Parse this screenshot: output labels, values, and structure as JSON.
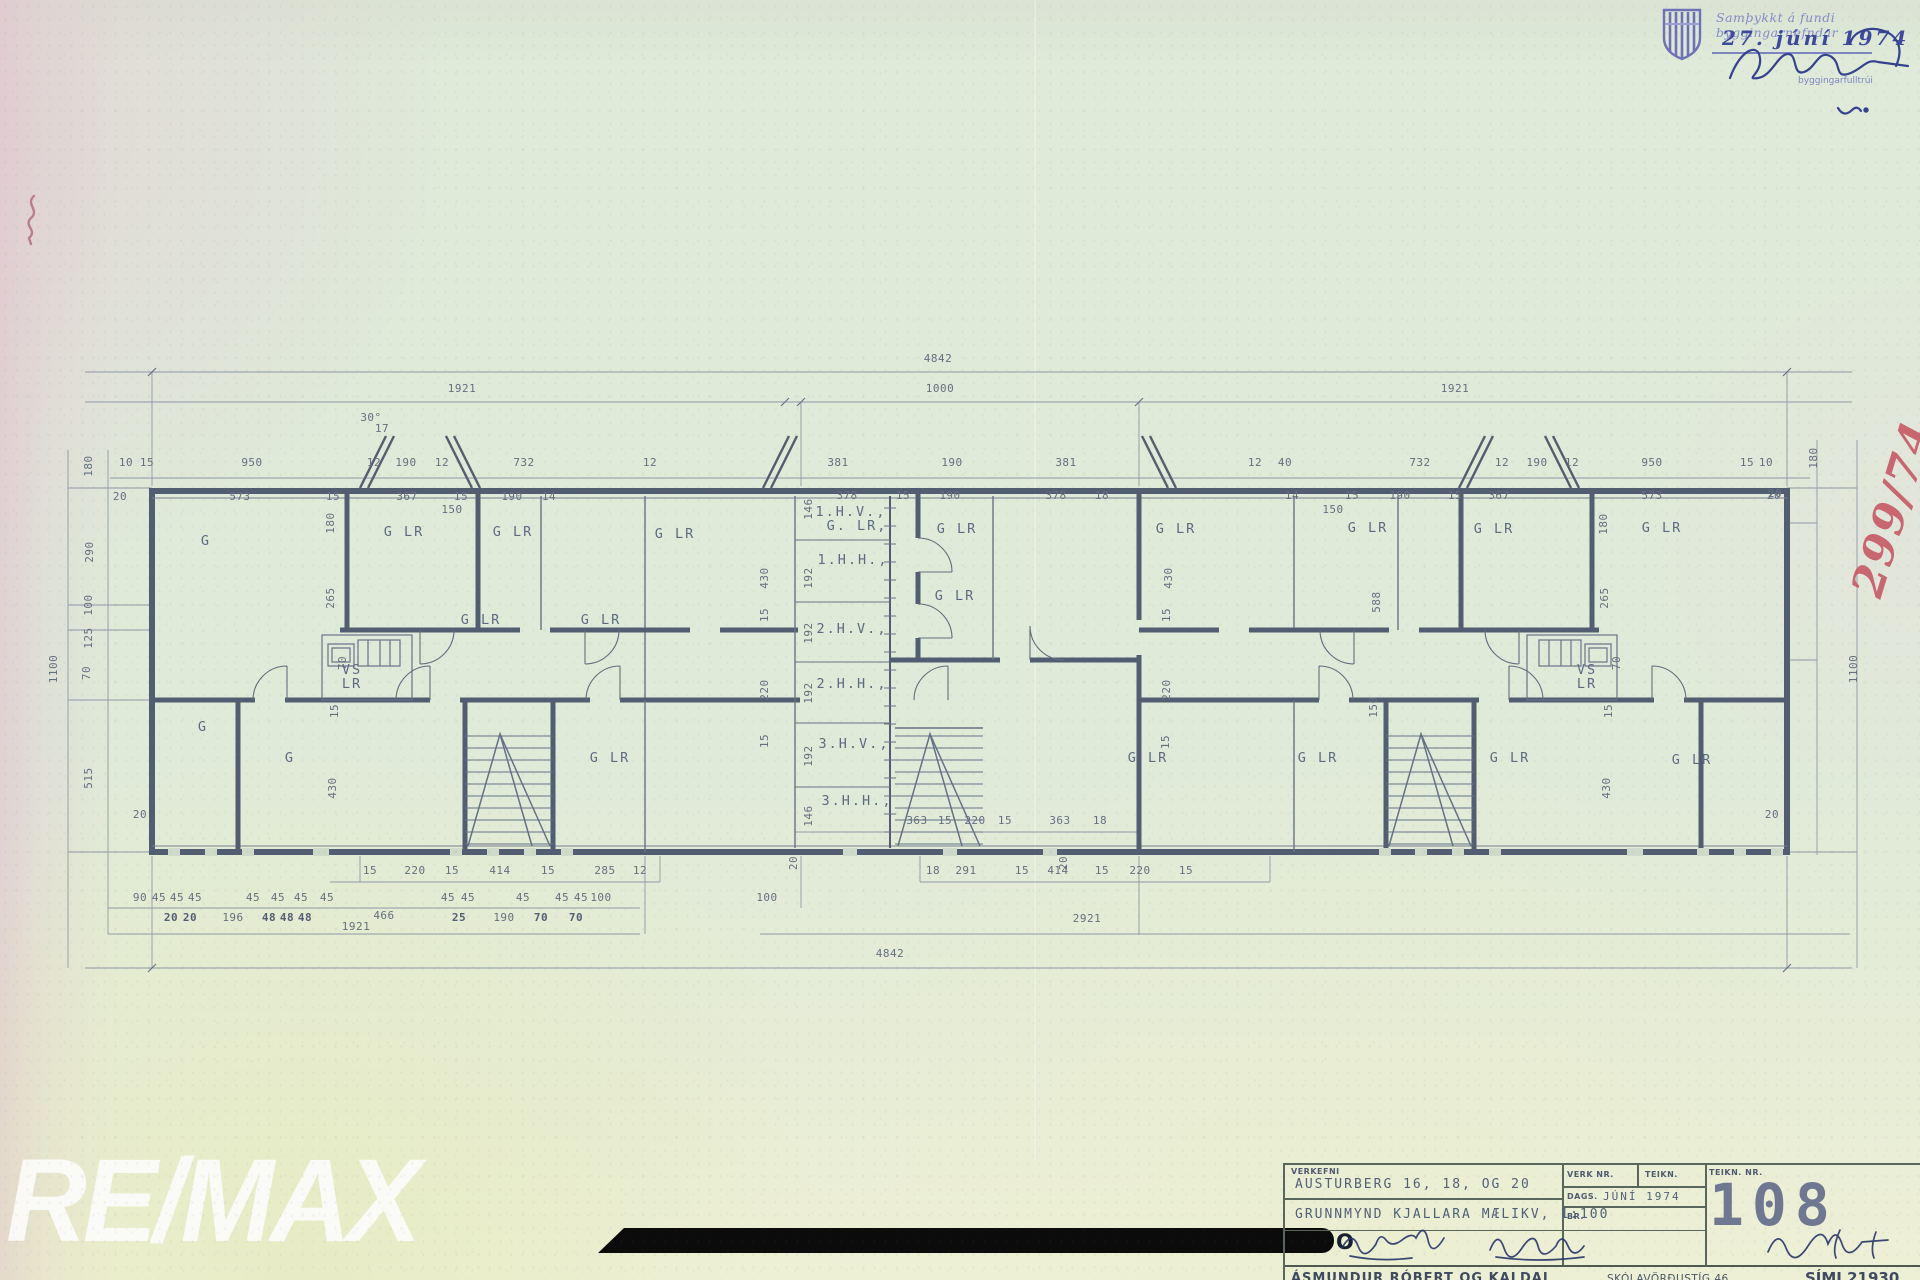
{
  "stamp": {
    "line1": "Samþykkt á fundi byggingarnefndar",
    "date": "27. júní 1974",
    "official": "byggingarfulltrúi"
  },
  "red_note": {
    "text": "299/74"
  },
  "watermark": {
    "text": "RE/MAX",
    "redacted_letter": "O"
  },
  "title_block": {
    "verkefni_label": "VERKEFNI",
    "project": "AUSTURBERG  16, 18, OG 20",
    "drawing_title": "GRUNNMYND KJALLARA  MÆLIKV, 1:100",
    "verk_nr_label": "VERK NR.",
    "teikn_label": "TEIKN.",
    "dags_label": "DAGS.",
    "dags_value": "JÚNÍ 1974",
    "br_label": "BR.",
    "teikn_nr_label": "TEIKN. NR.",
    "drawing_number": "108",
    "firm": "ÁSMUNDUR RÓBERT OG KALDAL",
    "address": "SKÓLAVÖRÐUSTÍG 46",
    "phone": "SÍMI 21930"
  },
  "plan": {
    "ink_color": "#49536a",
    "dim_color": "#5c6679",
    "dims": [
      {
        "t": "4842",
        "x": 938,
        "y": 362
      },
      {
        "t": "1921",
        "x": 462,
        "y": 392
      },
      {
        "t": "1000",
        "x": 940,
        "y": 392
      },
      {
        "t": "1921",
        "x": 1455,
        "y": 392
      },
      {
        "t": "10",
        "x": 126,
        "y": 466
      },
      {
        "t": "15",
        "x": 147,
        "y": 466
      },
      {
        "t": "950",
        "x": 252,
        "y": 466
      },
      {
        "t": "12",
        "x": 374,
        "y": 466
      },
      {
        "t": "190",
        "x": 406,
        "y": 466
      },
      {
        "t": "12",
        "x": 442,
        "y": 466
      },
      {
        "t": "732",
        "x": 524,
        "y": 466
      },
      {
        "t": "12",
        "x": 650,
        "y": 466
      },
      {
        "t": "381",
        "x": 838,
        "y": 466
      },
      {
        "t": "190",
        "x": 952,
        "y": 466
      },
      {
        "t": "381",
        "x": 1066,
        "y": 466
      },
      {
        "t": "12",
        "x": 1255,
        "y": 466
      },
      {
        "t": "40",
        "x": 1285,
        "y": 466
      },
      {
        "t": "732",
        "x": 1420,
        "y": 466
      },
      {
        "t": "12",
        "x": 1502,
        "y": 466
      },
      {
        "t": "190",
        "x": 1537,
        "y": 466
      },
      {
        "t": "12",
        "x": 1572,
        "y": 466
      },
      {
        "t": "950",
        "x": 1652,
        "y": 466
      },
      {
        "t": "15",
        "x": 1747,
        "y": 466
      },
      {
        "t": "10",
        "x": 1766,
        "y": 466
      },
      {
        "t": "20",
        "x": 120,
        "y": 500
      },
      {
        "t": "573",
        "x": 240,
        "y": 500
      },
      {
        "t": "15",
        "x": 333,
        "y": 500
      },
      {
        "t": "367",
        "x": 407,
        "y": 500
      },
      {
        "t": "15",
        "x": 461,
        "y": 500
      },
      {
        "t": "190",
        "x": 512,
        "y": 500
      },
      {
        "t": "14",
        "x": 549,
        "y": 500
      },
      {
        "t": "150",
        "x": 452,
        "y": 513
      },
      {
        "t": "378",
        "x": 847,
        "y": 499
      },
      {
        "t": "15",
        "x": 903,
        "y": 499
      },
      {
        "t": "190",
        "x": 950,
        "y": 499
      },
      {
        "t": "378",
        "x": 1056,
        "y": 499
      },
      {
        "t": "18",
        "x": 1102,
        "y": 499
      },
      {
        "t": "14",
        "x": 1292,
        "y": 499
      },
      {
        "t": "15",
        "x": 1352,
        "y": 499
      },
      {
        "t": "190",
        "x": 1400,
        "y": 499
      },
      {
        "t": "15",
        "x": 1455,
        "y": 499
      },
      {
        "t": "367",
        "x": 1499,
        "y": 499
      },
      {
        "t": "573",
        "x": 1652,
        "y": 499
      },
      {
        "t": "20",
        "x": 1774,
        "y": 499
      },
      {
        "t": "150",
        "x": 1333,
        "y": 513
      },
      {
        "t": "30°",
        "x": 371,
        "y": 421,
        "s": 9
      },
      {
        "t": "17",
        "x": 382,
        "y": 432,
        "s": 9
      },
      {
        "t": "180",
        "x": 92,
        "y": 466,
        "r": -90
      },
      {
        "t": "290",
        "x": 93,
        "y": 552,
        "r": -90
      },
      {
        "t": "100",
        "x": 92,
        "y": 605,
        "r": -90
      },
      {
        "t": "125",
        "x": 92,
        "y": 638,
        "r": -90
      },
      {
        "t": "70",
        "x": 90,
        "y": 673,
        "r": -90
      },
      {
        "t": "515",
        "x": 92,
        "y": 778,
        "r": -90
      },
      {
        "t": "1100",
        "x": 57,
        "y": 669,
        "r": -90
      },
      {
        "t": "20",
        "x": 140,
        "y": 818
      },
      {
        "t": "180",
        "x": 334,
        "y": 523,
        "r": -90
      },
      {
        "t": "265",
        "x": 334,
        "y": 598,
        "r": -90
      },
      {
        "t": "70",
        "x": 346,
        "y": 663,
        "r": -90
      },
      {
        "t": "15",
        "x": 338,
        "y": 711,
        "r": -90
      },
      {
        "t": "430",
        "x": 336,
        "y": 788,
        "r": -90
      },
      {
        "t": "430",
        "x": 768,
        "y": 578,
        "r": -90
      },
      {
        "t": "15",
        "x": 768,
        "y": 615,
        "r": -90
      },
      {
        "t": "220",
        "x": 768,
        "y": 690,
        "r": -90
      },
      {
        "t": "15",
        "x": 768,
        "y": 741,
        "r": -90
      },
      {
        "t": "146",
        "x": 812,
        "y": 509,
        "r": -90
      },
      {
        "t": "192",
        "x": 812,
        "y": 578,
        "r": -90
      },
      {
        "t": "192",
        "x": 812,
        "y": 633,
        "r": -90
      },
      {
        "t": "192",
        "x": 812,
        "y": 693,
        "r": -90
      },
      {
        "t": "192",
        "x": 812,
        "y": 756,
        "r": -90
      },
      {
        "t": "146",
        "x": 812,
        "y": 816,
        "r": -90
      },
      {
        "t": "430",
        "x": 1172,
        "y": 578,
        "r": -90
      },
      {
        "t": "15",
        "x": 1170,
        "y": 615,
        "r": -90
      },
      {
        "t": "220",
        "x": 1170,
        "y": 690,
        "r": -90
      },
      {
        "t": "15",
        "x": 1169,
        "y": 742,
        "r": -90
      },
      {
        "t": "588",
        "x": 1380,
        "y": 602,
        "r": -90
      },
      {
        "t": "150",
        "x": 1377,
        "y": 707,
        "r": -90
      },
      {
        "t": "180",
        "x": 1607,
        "y": 524,
        "r": -90
      },
      {
        "t": "265",
        "x": 1608,
        "y": 598,
        "r": -90
      },
      {
        "t": "70",
        "x": 1620,
        "y": 663,
        "r": -90
      },
      {
        "t": "15",
        "x": 1612,
        "y": 711,
        "r": -90
      },
      {
        "t": "430",
        "x": 1610,
        "y": 788,
        "r": -90
      },
      {
        "t": "180",
        "x": 1817,
        "y": 458,
        "r": -90
      },
      {
        "t": "20",
        "x": 1775,
        "y": 497
      },
      {
        "t": "1100",
        "x": 1857,
        "y": 669,
        "r": -90
      },
      {
        "t": "20",
        "x": 1772,
        "y": 818
      },
      {
        "t": "363",
        "x": 917,
        "y": 824
      },
      {
        "t": "15",
        "x": 945,
        "y": 824
      },
      {
        "t": "220",
        "x": 975,
        "y": 824
      },
      {
        "t": "15",
        "x": 1005,
        "y": 824
      },
      {
        "t": "363",
        "x": 1060,
        "y": 824
      },
      {
        "t": "18",
        "x": 1100,
        "y": 824
      },
      {
        "t": "20",
        "x": 797,
        "y": 863,
        "r": -90
      },
      {
        "t": "20",
        "x": 1067,
        "y": 863,
        "r": -90
      },
      {
        "t": "15",
        "x": 370,
        "y": 874
      },
      {
        "t": "220",
        "x": 415,
        "y": 874
      },
      {
        "t": "15",
        "x": 452,
        "y": 874
      },
      {
        "t": "414",
        "x": 500,
        "y": 874
      },
      {
        "t": "15",
        "x": 548,
        "y": 874
      },
      {
        "t": "285",
        "x": 605,
        "y": 874
      },
      {
        "t": "12",
        "x": 640,
        "y": 874
      },
      {
        "t": "18",
        "x": 933,
        "y": 874
      },
      {
        "t": "291",
        "x": 966,
        "y": 874
      },
      {
        "t": "15",
        "x": 1022,
        "y": 874
      },
      {
        "t": "414",
        "x": 1058,
        "y": 874
      },
      {
        "t": "15",
        "x": 1102,
        "y": 874
      },
      {
        "t": "220",
        "x": 1140,
        "y": 874
      },
      {
        "t": "15",
        "x": 1186,
        "y": 874
      },
      {
        "t": "90",
        "x": 140,
        "y": 901
      },
      {
        "t": "45",
        "x": 159,
        "y": 901
      },
      {
        "t": "45",
        "x": 177,
        "y": 901
      },
      {
        "t": "45",
        "x": 195,
        "y": 901
      },
      {
        "t": "45",
        "x": 253,
        "y": 901
      },
      {
        "t": "45",
        "x": 278,
        "y": 901
      },
      {
        "t": "45",
        "x": 301,
        "y": 901
      },
      {
        "t": "45",
        "x": 327,
        "y": 901
      },
      {
        "t": "45",
        "x": 448,
        "y": 901
      },
      {
        "t": "45",
        "x": 468,
        "y": 901
      },
      {
        "t": "45",
        "x": 523,
        "y": 901
      },
      {
        "t": "45",
        "x": 562,
        "y": 901
      },
      {
        "t": "45",
        "x": 581,
        "y": 901
      },
      {
        "t": "100",
        "x": 601,
        "y": 901
      },
      {
        "t": "100",
        "x": 767,
        "y": 901
      },
      {
        "t": "20",
        "x": 171,
        "y": 921,
        "b": 1
      },
      {
        "t": "20",
        "x": 190,
        "y": 921,
        "b": 1
      },
      {
        "t": "196",
        "x": 233,
        "y": 921
      },
      {
        "t": "48",
        "x": 269,
        "y": 921,
        "b": 1
      },
      {
        "t": "48",
        "x": 287,
        "y": 921,
        "b": 1
      },
      {
        "t": "48",
        "x": 305,
        "y": 921,
        "b": 1
      },
      {
        "t": "1921",
        "x": 356,
        "y": 930
      },
      {
        "t": "466",
        "x": 384,
        "y": 919
      },
      {
        "t": "25",
        "x": 459,
        "y": 921,
        "b": 1
      },
      {
        "t": "190",
        "x": 504,
        "y": 921
      },
      {
        "t": "70",
        "x": 541,
        "y": 921,
        "b": 1
      },
      {
        "t": "70",
        "x": 576,
        "y": 921,
        "b": 1
      },
      {
        "t": "2921",
        "x": 1087,
        "y": 922
      },
      {
        "t": "4842",
        "x": 890,
        "y": 957
      }
    ],
    "rooms": [
      {
        "t": "G",
        "x": 206,
        "y": 545
      },
      {
        "t": "G  LR",
        "x": 404,
        "y": 536
      },
      {
        "t": "G  LR",
        "x": 513,
        "y": 536
      },
      {
        "t": "G  LR",
        "x": 675,
        "y": 538
      },
      {
        "t": "G  LR",
        "x": 481,
        "y": 624
      },
      {
        "t": "G  LR",
        "x": 601,
        "y": 624
      },
      {
        "t": "VS",
        "x": 352,
        "y": 674,
        "s": 11
      },
      {
        "t": "LR",
        "x": 352,
        "y": 688,
        "s": 11
      },
      {
        "t": "G",
        "x": 203,
        "y": 731
      },
      {
        "t": "G",
        "x": 290,
        "y": 762
      },
      {
        "t": "G  LR",
        "x": 610,
        "y": 762
      },
      {
        "t": "1.H.V.,",
        "x": 851,
        "y": 516,
        "s": 12
      },
      {
        "t": "G.  LR,",
        "x": 857,
        "y": 530,
        "s": 12
      },
      {
        "t": "1.H.H.,",
        "x": 853,
        "y": 564,
        "s": 12
      },
      {
        "t": "2.H.V.,",
        "x": 852,
        "y": 633,
        "s": 12
      },
      {
        "t": "2.H.H.,",
        "x": 852,
        "y": 688,
        "s": 12
      },
      {
        "t": "3.H.V.,",
        "x": 854,
        "y": 748,
        "s": 12
      },
      {
        "t": "3.H.H.,",
        "x": 857,
        "y": 805,
        "s": 12
      },
      {
        "t": "G  LR",
        "x": 957,
        "y": 533
      },
      {
        "t": "G  LR",
        "x": 955,
        "y": 600
      },
      {
        "t": "G  LR",
        "x": 1176,
        "y": 533
      },
      {
        "t": "G  LR",
        "x": 1368,
        "y": 532
      },
      {
        "t": "G  LR",
        "x": 1494,
        "y": 533
      },
      {
        "t": "G  LR",
        "x": 1662,
        "y": 532
      },
      {
        "t": "G  LR",
        "x": 1148,
        "y": 762
      },
      {
        "t": "G  LR",
        "x": 1318,
        "y": 762
      },
      {
        "t": "G  LR",
        "x": 1510,
        "y": 762
      },
      {
        "t": "G  LR",
        "x": 1692,
        "y": 764
      },
      {
        "t": "VS",
        "x": 1587,
        "y": 674,
        "s": 11
      },
      {
        "t": "LR",
        "x": 1587,
        "y": 688,
        "s": 11
      }
    ]
  }
}
